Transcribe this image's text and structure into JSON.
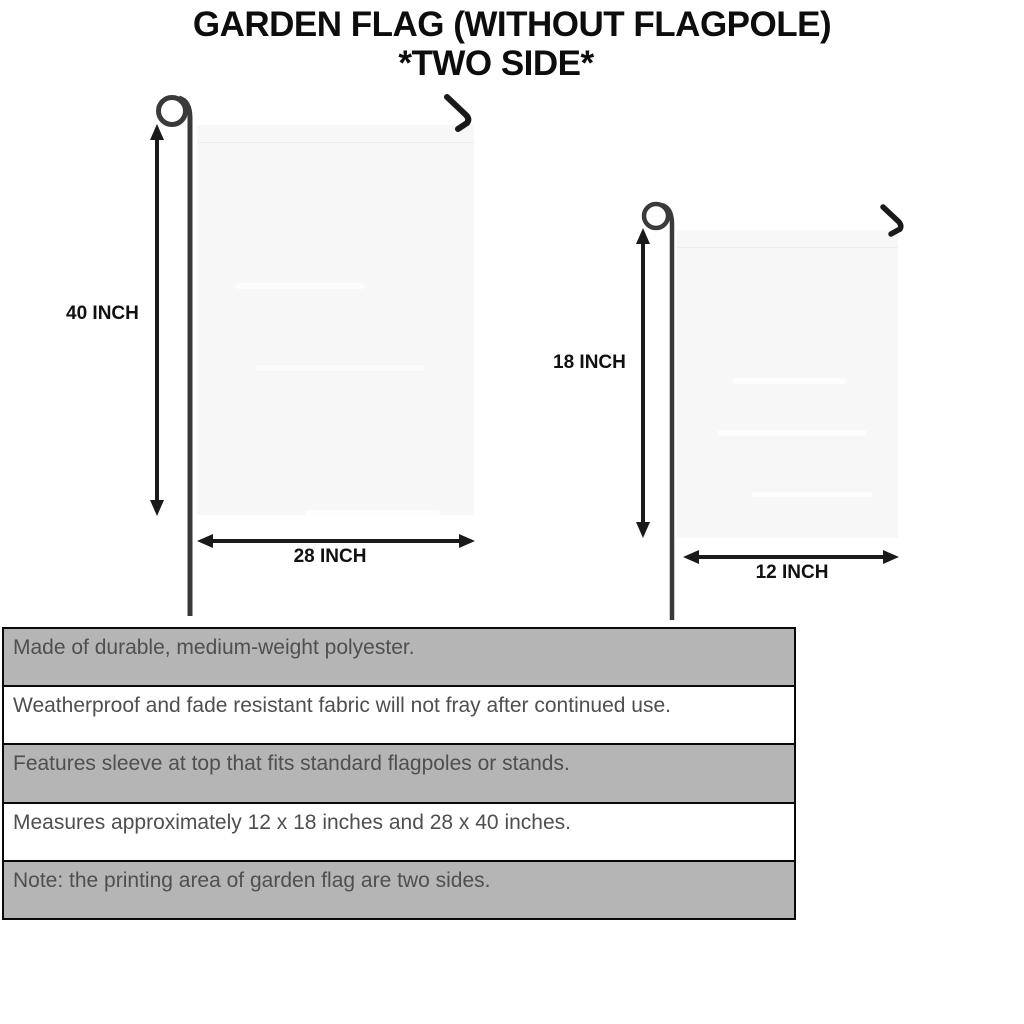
{
  "title": {
    "line1": "GARDEN FLAG (WITHOUT FLAGPOLE)",
    "line2": "*TWO SIDE*"
  },
  "flags": {
    "large": {
      "height_label": "40 INCH",
      "width_label": "28 INCH"
    },
    "small": {
      "height_label": "18 INCH",
      "width_label": "12 INCH"
    }
  },
  "table": {
    "rows": [
      "Made of durable, medium-weight polyester.",
      "Weatherproof and fade resistant fabric will not fray after continued use.",
      "Features sleeve at top that fits standard flagpoles or stands.",
      "Measures approximately 12 x 18 inches and 28 x 40 inches.",
      "Note: the printing area of garden flag are two sides."
    ]
  },
  "icons": {
    "flagpole": "flagpole-wire-icon",
    "hook": "wire-hook-icon",
    "dimension_arrow": "double-headed-arrow-icon"
  },
  "colors": {
    "background": "#ffffff",
    "title_text": "#0d0d0d",
    "label_text": "#111111",
    "wire": "#3a3a3a",
    "arrow": "#1a1a1a",
    "flag_fill": "#f7f7f7",
    "flag_seam": "#ededed",
    "row_gray": "#b5b5b5",
    "row_white": "#ffffff",
    "table_border": "#0a0a0a",
    "table_text": "#4f4f4f"
  }
}
